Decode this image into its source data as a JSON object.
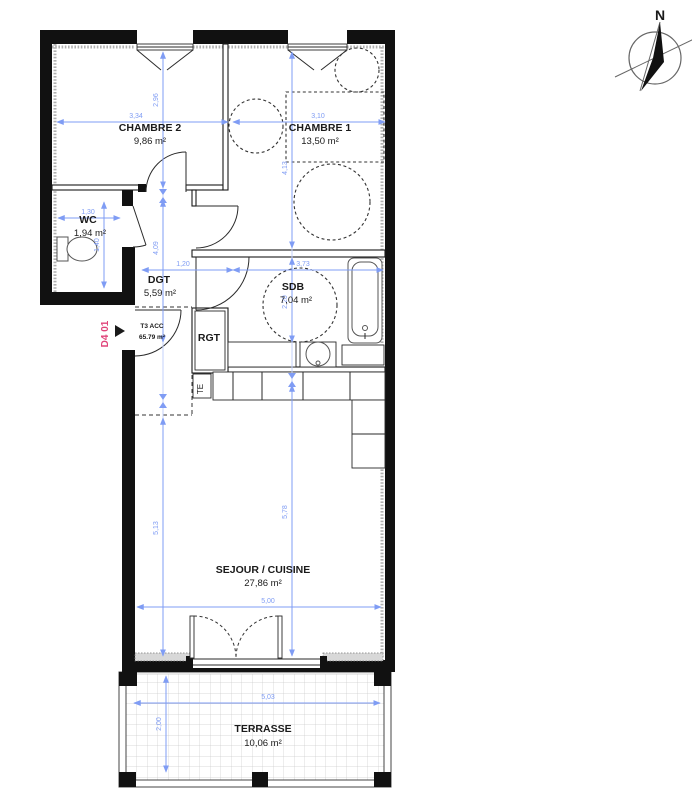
{
  "plan": {
    "unit_tag": "D4 01",
    "type_code": "T3 ACC",
    "type_area": "65.79 m²",
    "north": "N",
    "rooms": {
      "chambre2": {
        "name": "CHAMBRE 2",
        "area": "9,86 m²"
      },
      "chambre1": {
        "name": "CHAMBRE 1",
        "area": "13,50 m²"
      },
      "wc": {
        "name": "WC",
        "area": "1,94 m²"
      },
      "dgt": {
        "name": "DGT",
        "area": "5,59 m²"
      },
      "sdb": {
        "name": "SDB",
        "area": "7,04 m²"
      },
      "rgt": {
        "name": "RGT"
      },
      "te": {
        "name": "TE"
      },
      "sejour": {
        "name": "SEJOUR / CUISINE",
        "area": "27,86 m²"
      },
      "terrasse": {
        "name": "TERRASSE",
        "area": "10,06 m²"
      }
    },
    "dims": {
      "chambre2_w": "3,34",
      "chambre2_h": "2,96",
      "chambre1_w": "3,10",
      "chambre1_h": "4,13",
      "wc_w": "1,30",
      "wc_h": "1,40",
      "dgt_h": "4,09",
      "dgt_passage": "1,20",
      "sdb_w": "3,73",
      "sdb_h": "2,20",
      "sejour_h_left": "5,13",
      "sejour_h_right": "5,78",
      "sejour_w": "5,00",
      "terrasse_w": "5,03",
      "terrasse_h": "2,00"
    },
    "colors": {
      "dimension": "#7f9cf4",
      "unit_label": "#e0457b",
      "wall": "#111111"
    }
  }
}
